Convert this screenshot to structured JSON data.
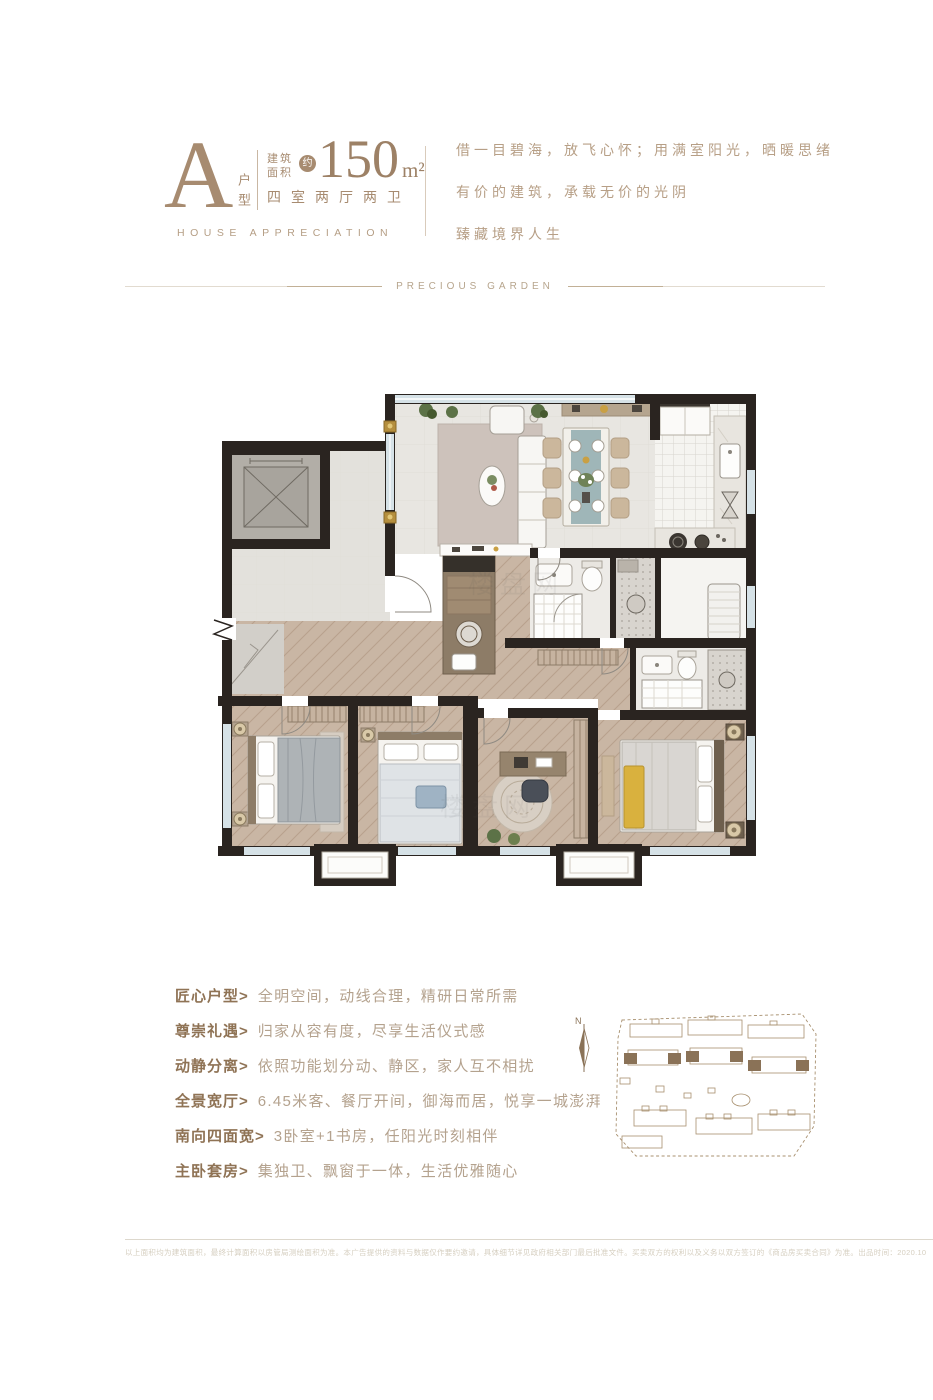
{
  "header": {
    "type_letter": "A",
    "type_label": "户型",
    "area_label_1": "建筑",
    "area_label_2": "面积",
    "area_approx": "约",
    "area_value": "150",
    "area_unit": "m²",
    "layout_text": "四室两厅两卫",
    "subtitle_en": "HOUSE APPRECIATION"
  },
  "tagline": {
    "line1": "借一目碧海，放飞心怀；用满室阳光，晒暖思绪",
    "line2": "有价的建筑，承载无价的光阴",
    "line3": "臻藏境界人生"
  },
  "divider": {
    "label": "PRECIOUS GARDEN"
  },
  "floorplan": {
    "watermark": "楼盘网"
  },
  "features": [
    {
      "label": "匠心户型>",
      "desc": "全明空间，动线合理，精研日常所需"
    },
    {
      "label": "尊崇礼遇>",
      "desc": "归家从容有度，尽享生活仪式感"
    },
    {
      "label": "动静分离>",
      "desc": "依照功能划分动、静区，家人互不相扰"
    },
    {
      "label": "全景宽厅>",
      "desc": "6.45米客、餐厅开间，御海而居，悦享一城澎湃"
    },
    {
      "label": "南向四面宽>",
      "desc": "3卧室+1书房，任阳光时刻相伴"
    },
    {
      "label": "主卧套房>",
      "desc": "集独卫、飘窗于一体，生活优雅随心"
    }
  ],
  "site_plan": {
    "compass_label": "N"
  },
  "footer": {
    "disclaimer": "以上面积均为建筑面积，最终计算面积以房管局测绘面积为准。本广告提供的资料与数据仅作要约邀请，具体细节详见政府相关部门最后批准文件。买卖双方的权利以及义务以双方签订的《商品房买卖合同》为准。出品时间：2020.10"
  },
  "colors": {
    "brand_tan": "#a78b70",
    "text_light_tan": "#b4a28e",
    "wall_dark": "#2a2420",
    "accent_yellow": "#d9b13e"
  }
}
